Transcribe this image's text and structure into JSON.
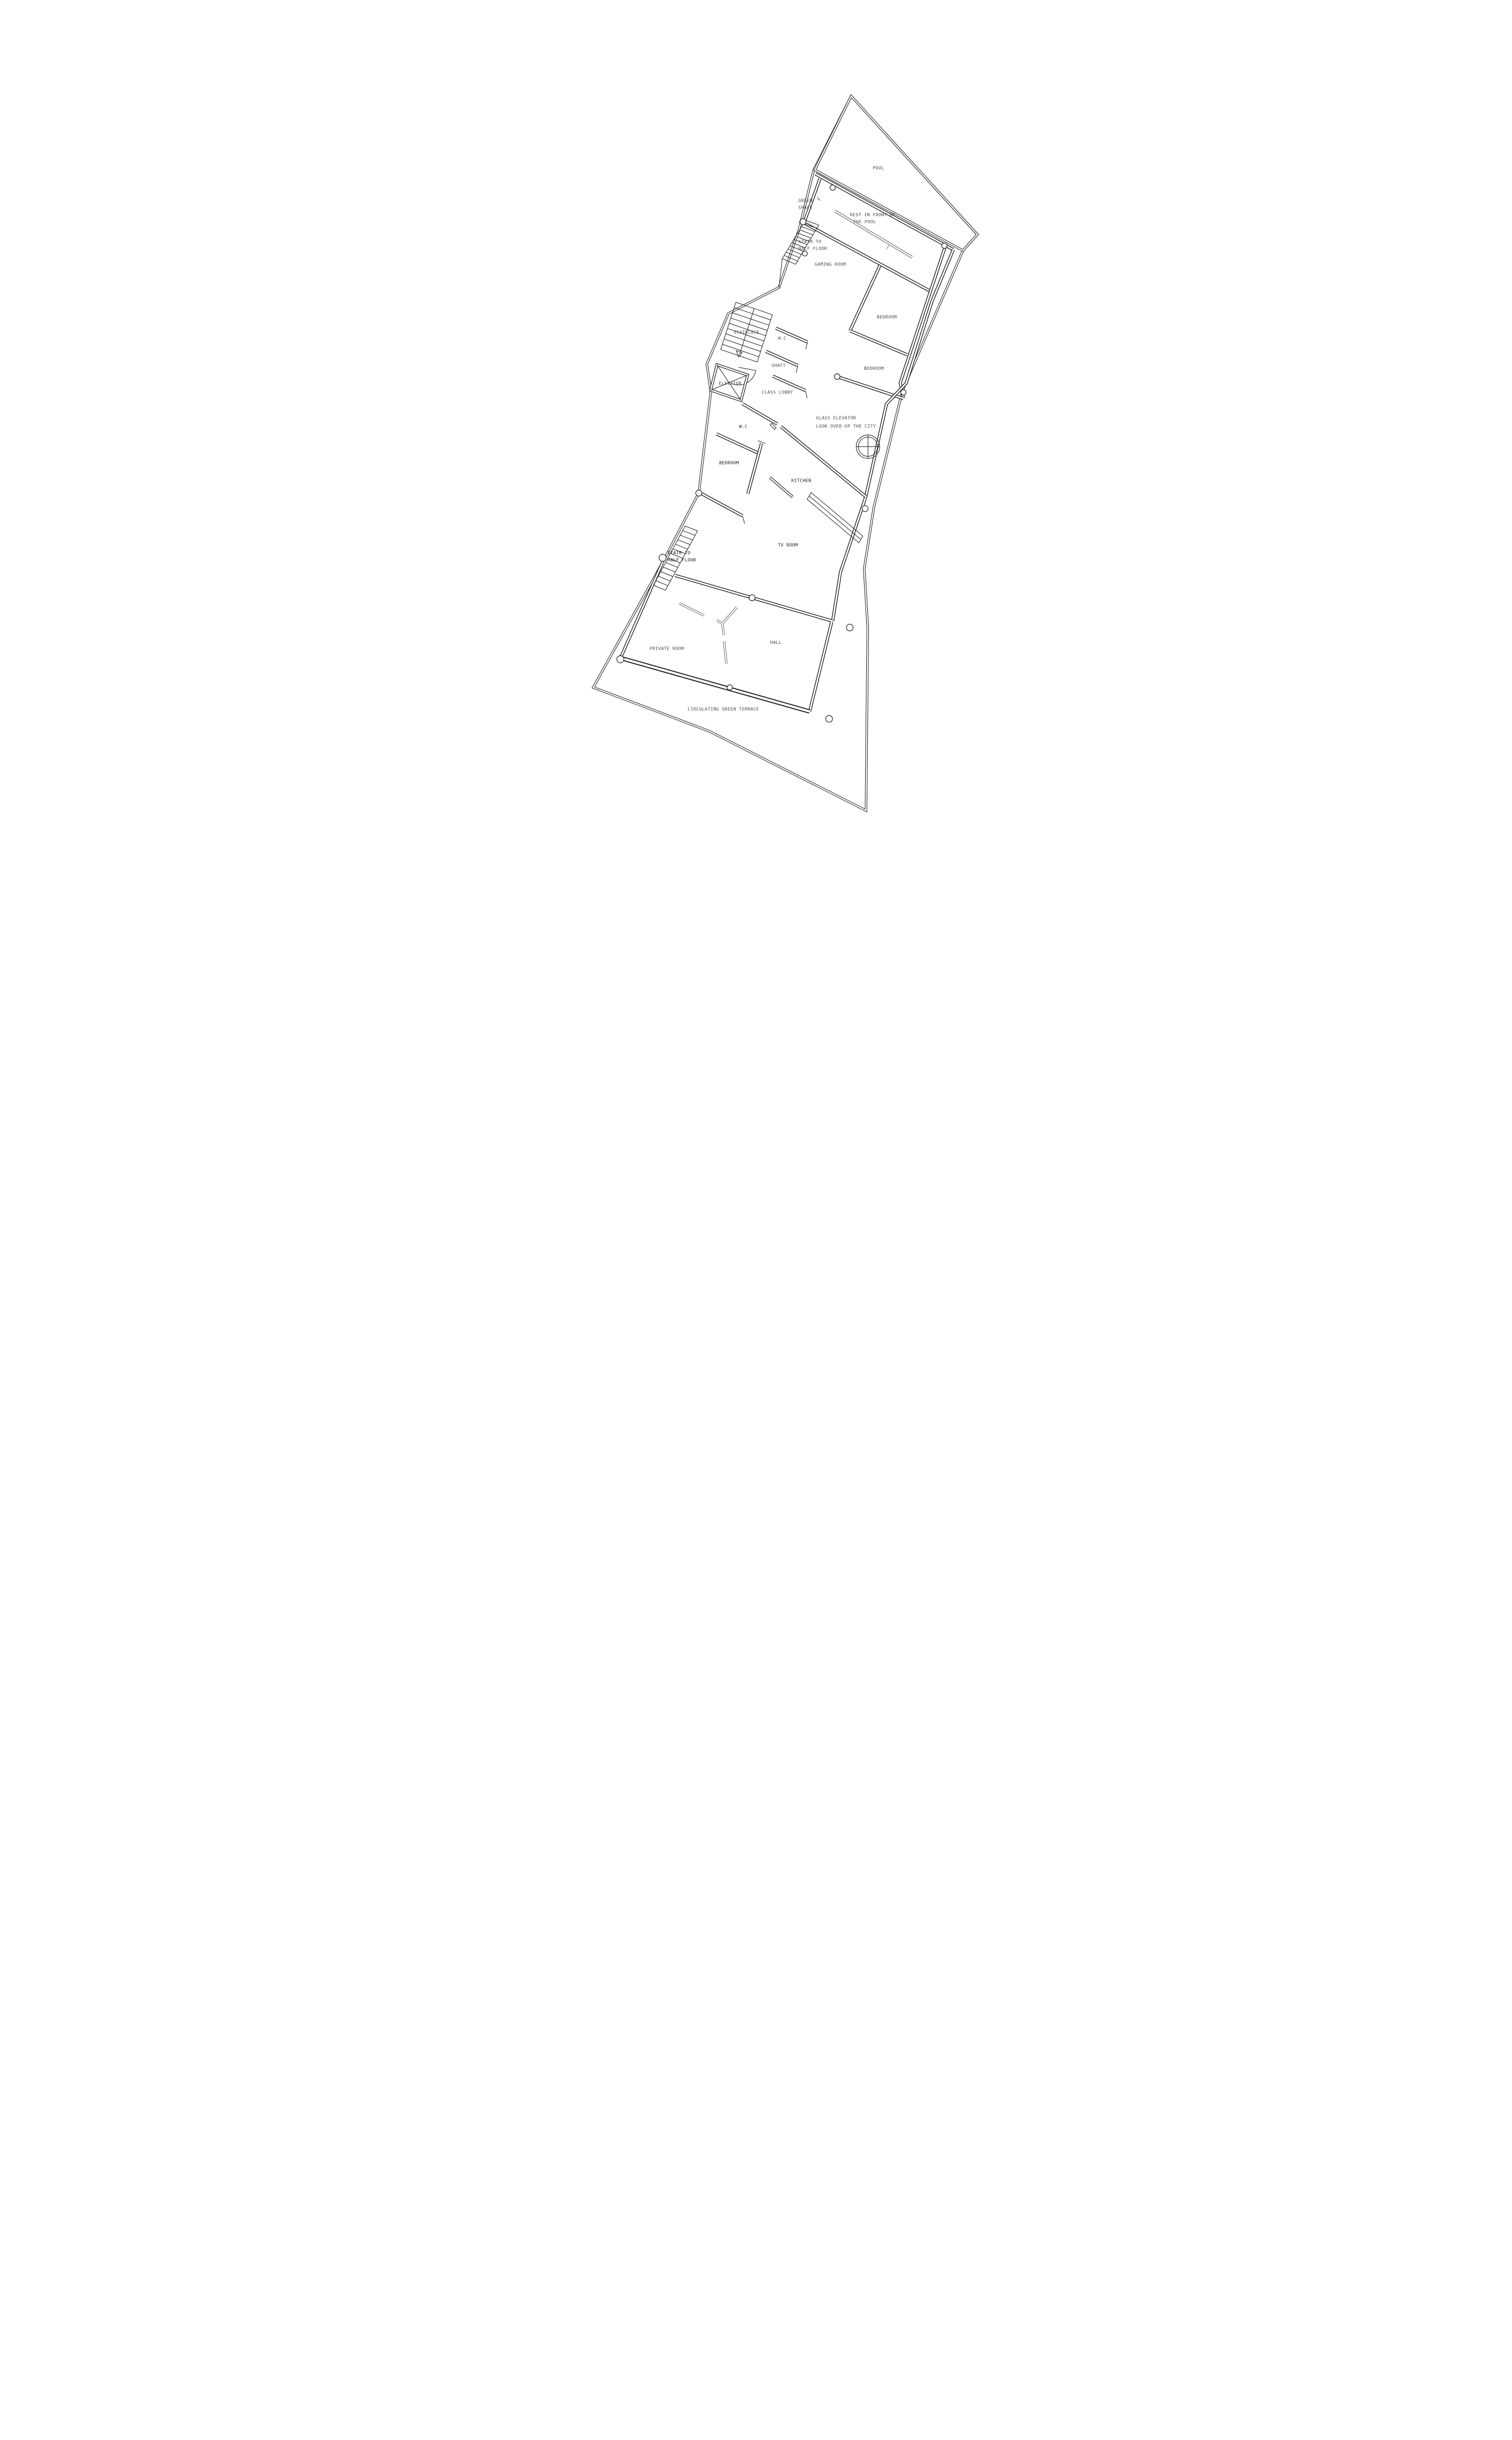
{
  "plan": {
    "rooms": {
      "pool": "POOL",
      "green_space_1": "GREEN",
      "green_space_2": "SPACE",
      "rest_1": "REST IN FRONT OF",
      "rest_2": "THE POOL",
      "stair_top_1": "STAIR TO",
      "stair_top_2": "HALF FLOOR",
      "gaming_room": "GAMING ROOM",
      "bedroom_upper": "BEDROOM",
      "bedroom_mid": "BEDROOM",
      "staircase": "STAIRCASE",
      "wc_upper": "W.C",
      "shaft": "SHAFT",
      "elevator": "ELEVATOR",
      "class_lobby": "CLASS LOBBY",
      "glass_elevator_1": "GLASS ELEVATOR",
      "glass_elevator_2": "LOOK OVER-UP THE CITY",
      "wc_lower": "W.C",
      "bedroom_lower": "BEDROOM",
      "kitchen": "KITCHEN",
      "tv_room": "TV ROOM",
      "stair_bottom_1": "STAIR TO",
      "stair_bottom_2": "HALF FLOOR",
      "private_room": "PRIVATE ROOM",
      "hall": "HALL",
      "terrace": "CIRCULATING GREEN TERRACE"
    },
    "colors": {
      "line": "#1a1a1a",
      "label_gray": "#4a4a4a",
      "label_dark": "#161616",
      "furniture_gray": "#6b6b6b",
      "background": "#ffffff"
    }
  }
}
